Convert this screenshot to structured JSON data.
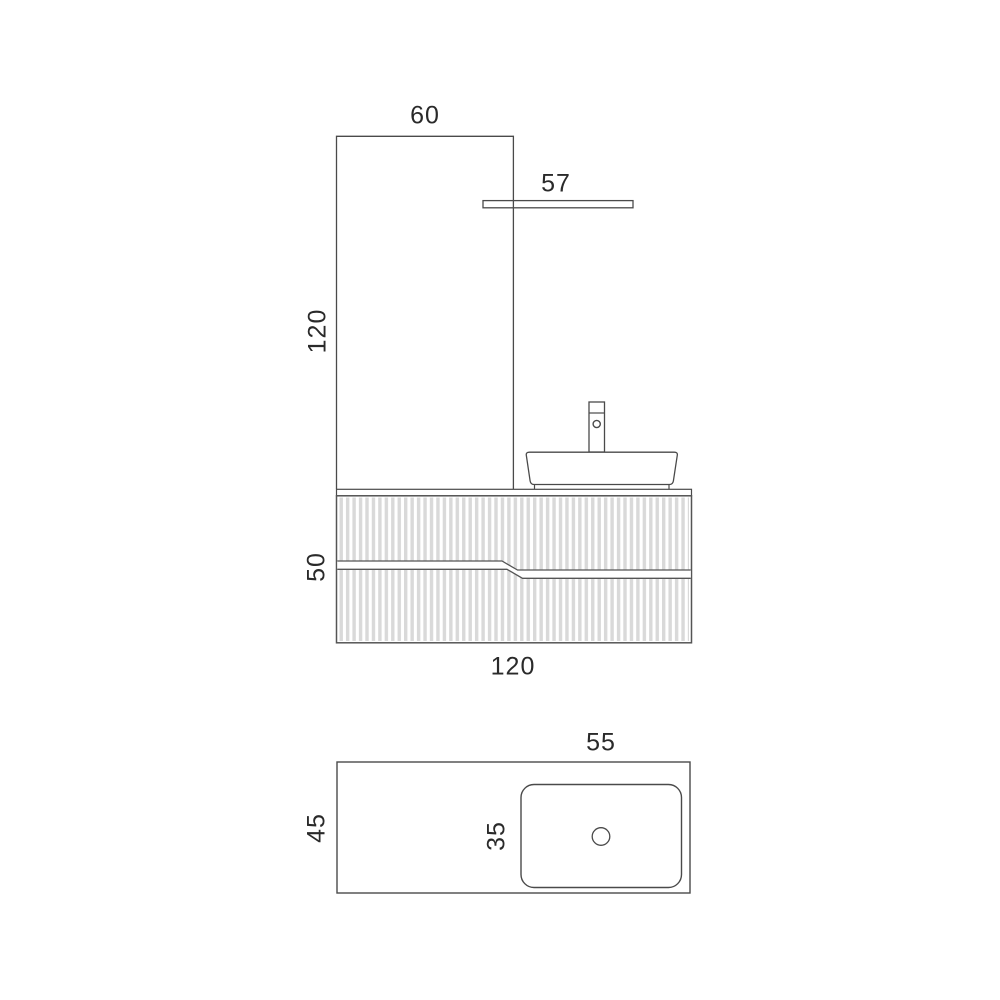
{
  "drawing": {
    "type": "bathroom-vanity-technical-drawing",
    "front_view": {
      "panel_width": "60",
      "shelf_width": "57",
      "panel_height": "120",
      "cabinet_height": "50",
      "cabinet_width": "120"
    },
    "plan_view": {
      "countertop_depth": "45",
      "basin_width": "55",
      "basin_depth": "35"
    },
    "colors": {
      "background": "#ffffff",
      "line": "#4a4a4a",
      "text": "#2a2a2a",
      "flute_stripe": "#d9d9d9"
    }
  }
}
